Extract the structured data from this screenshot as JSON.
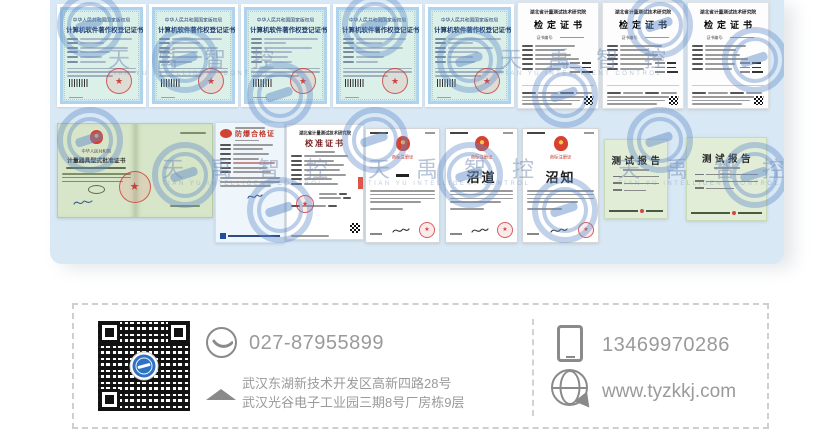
{
  "watermark": {
    "text": "天禹智控",
    "subtext": "TIAN YU INTELLIGENT CONTROL"
  },
  "certs": {
    "software_copyright": {
      "title_line1": "中华人民共和国国家版权局",
      "title_line2": "计算机软件著作权登记证书"
    },
    "verification": {
      "org": "湖北省计量测试技术研究院",
      "title": "检定证书",
      "cert_no_label": "证书编号:"
    },
    "type_approval": {
      "country": "中华人民共和国",
      "title": "计量器具型式批准证书"
    },
    "explosion_proof": {
      "title": "防爆合格证"
    },
    "calibration": {
      "org": "湖北省计量测试技术研究院",
      "title": "校准证书"
    },
    "trademark": {
      "label": "商标注册证",
      "mark2": "沼道",
      "mark3": "沼知"
    },
    "test_report": {
      "title": "测试报告"
    }
  },
  "footer": {
    "phone": "027-87955899",
    "mobile": "13469970286",
    "website": "www.tyzkkj.com",
    "address_line1": "武汉东湖新技术开发区高新四路28号",
    "address_line2": "武汉光谷电子工业园三期8号厂房栋9层"
  },
  "colors": {
    "panel_bg": "#d9e8f5",
    "watermark_blue": "#618cc8",
    "stamp_red": "#cd2d2d",
    "footer_text": "#9a9a9a",
    "qr_logo_blue": "#2e72c4"
  }
}
